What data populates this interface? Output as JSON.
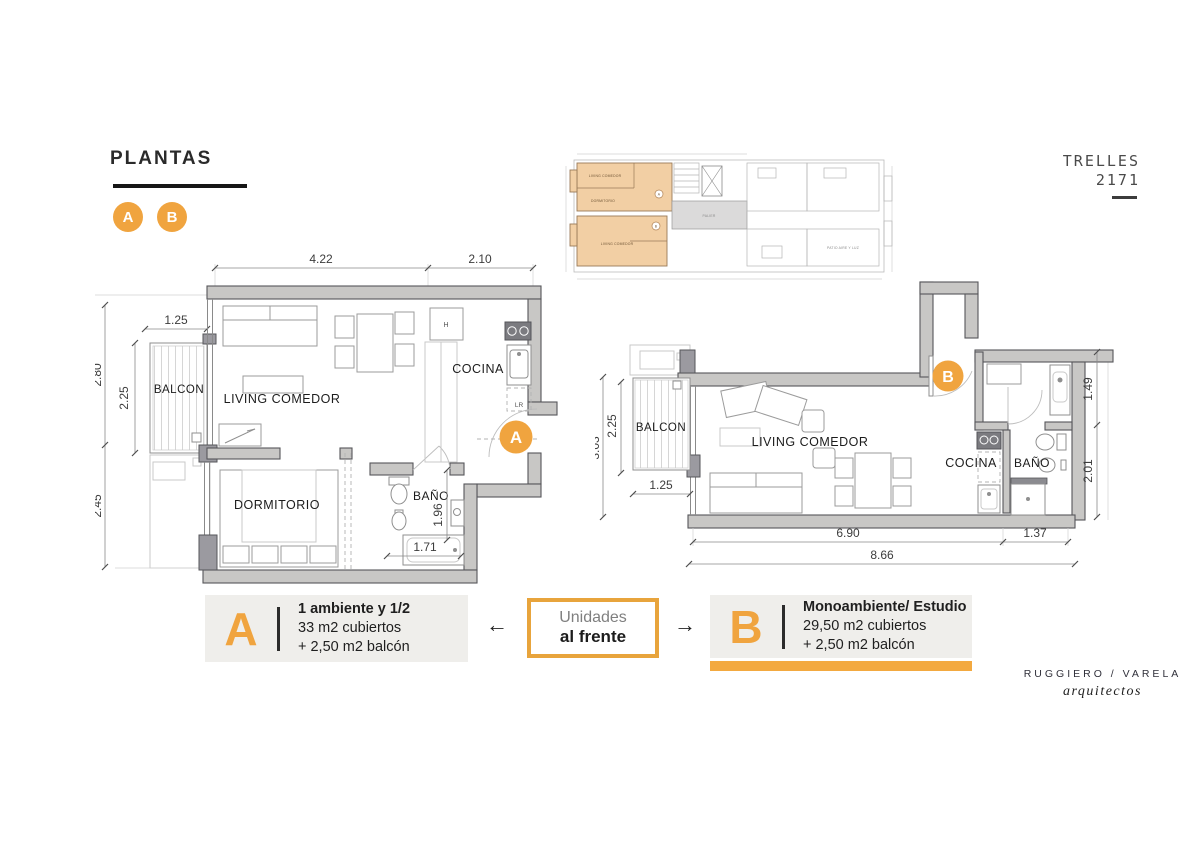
{
  "header": {
    "title": "PLANTAS",
    "badge_a": "A",
    "badge_b": "B"
  },
  "project": {
    "name": "TRELLES",
    "number": "2171"
  },
  "mini_plan": {
    "labels": {
      "living_a": "LIVING COMEDOR",
      "dormitorio": "DORMITORIO",
      "living_b": "LIVING COMEDOR",
      "palier": "PALIER",
      "patio": "PATIO AIRE Y LUZ",
      "marker_a": "A",
      "marker_b": "B"
    }
  },
  "plan_a": {
    "marker": "A",
    "rooms": {
      "balcon": "BALCON",
      "living": "LIVING COMEDOR",
      "cocina": "COCINA",
      "dormitorio": "DORMITORIO",
      "bano": "BAÑO"
    },
    "appliances": {
      "fridge": "H",
      "washer": "LR"
    },
    "dims": {
      "top_living": "4.22",
      "top_cocina": "2.10",
      "balcon_width": "1.25",
      "left_upper": "2.80",
      "balcon_depth": "2.25",
      "left_lower": "2.45",
      "bano_depth": "1.96",
      "bano_width": "1.71"
    }
  },
  "plan_b": {
    "marker": "B",
    "rooms": {
      "balcon": "BALCON",
      "living": "LIVING COMEDOR",
      "cocina": "COCINA",
      "bano": "BAÑO"
    },
    "dims": {
      "left_total": "3.03",
      "balcon_depth": "2.25",
      "balcon_width": "1.25",
      "right_upper": "1.49",
      "right_lower": "2.01",
      "bottom_living": "6.90",
      "bottom_service": "1.37",
      "bottom_total": "8.66"
    }
  },
  "legend": {
    "unit_a": {
      "letter": "A",
      "title": "1 ambiente y 1/2",
      "line1": "33 m2 cubiertos",
      "line2": "+ 2,50 m2 balcón"
    },
    "center": {
      "line1": "Unidades",
      "line2": "al frente",
      "arrow_left": "←",
      "arrow_right": "→"
    },
    "unit_b": {
      "letter": "B",
      "title": "Monoambiente/ Estudio",
      "line1": "29,50 m2 cubiertos",
      "line2": "+ 2,50 m2 balcón"
    }
  },
  "footer": {
    "firm": "RUGGIERO / VARELA",
    "subtitle": "arquitectos"
  },
  "colors": {
    "accent": "#F0A43F",
    "accent_bar": "#F3A940",
    "wall_fill": "#C8C7C5",
    "wall_dark": "#9B9AA0",
    "unit_highlight": "#F2CFA4",
    "legend_bg": "#EFEEEB"
  }
}
